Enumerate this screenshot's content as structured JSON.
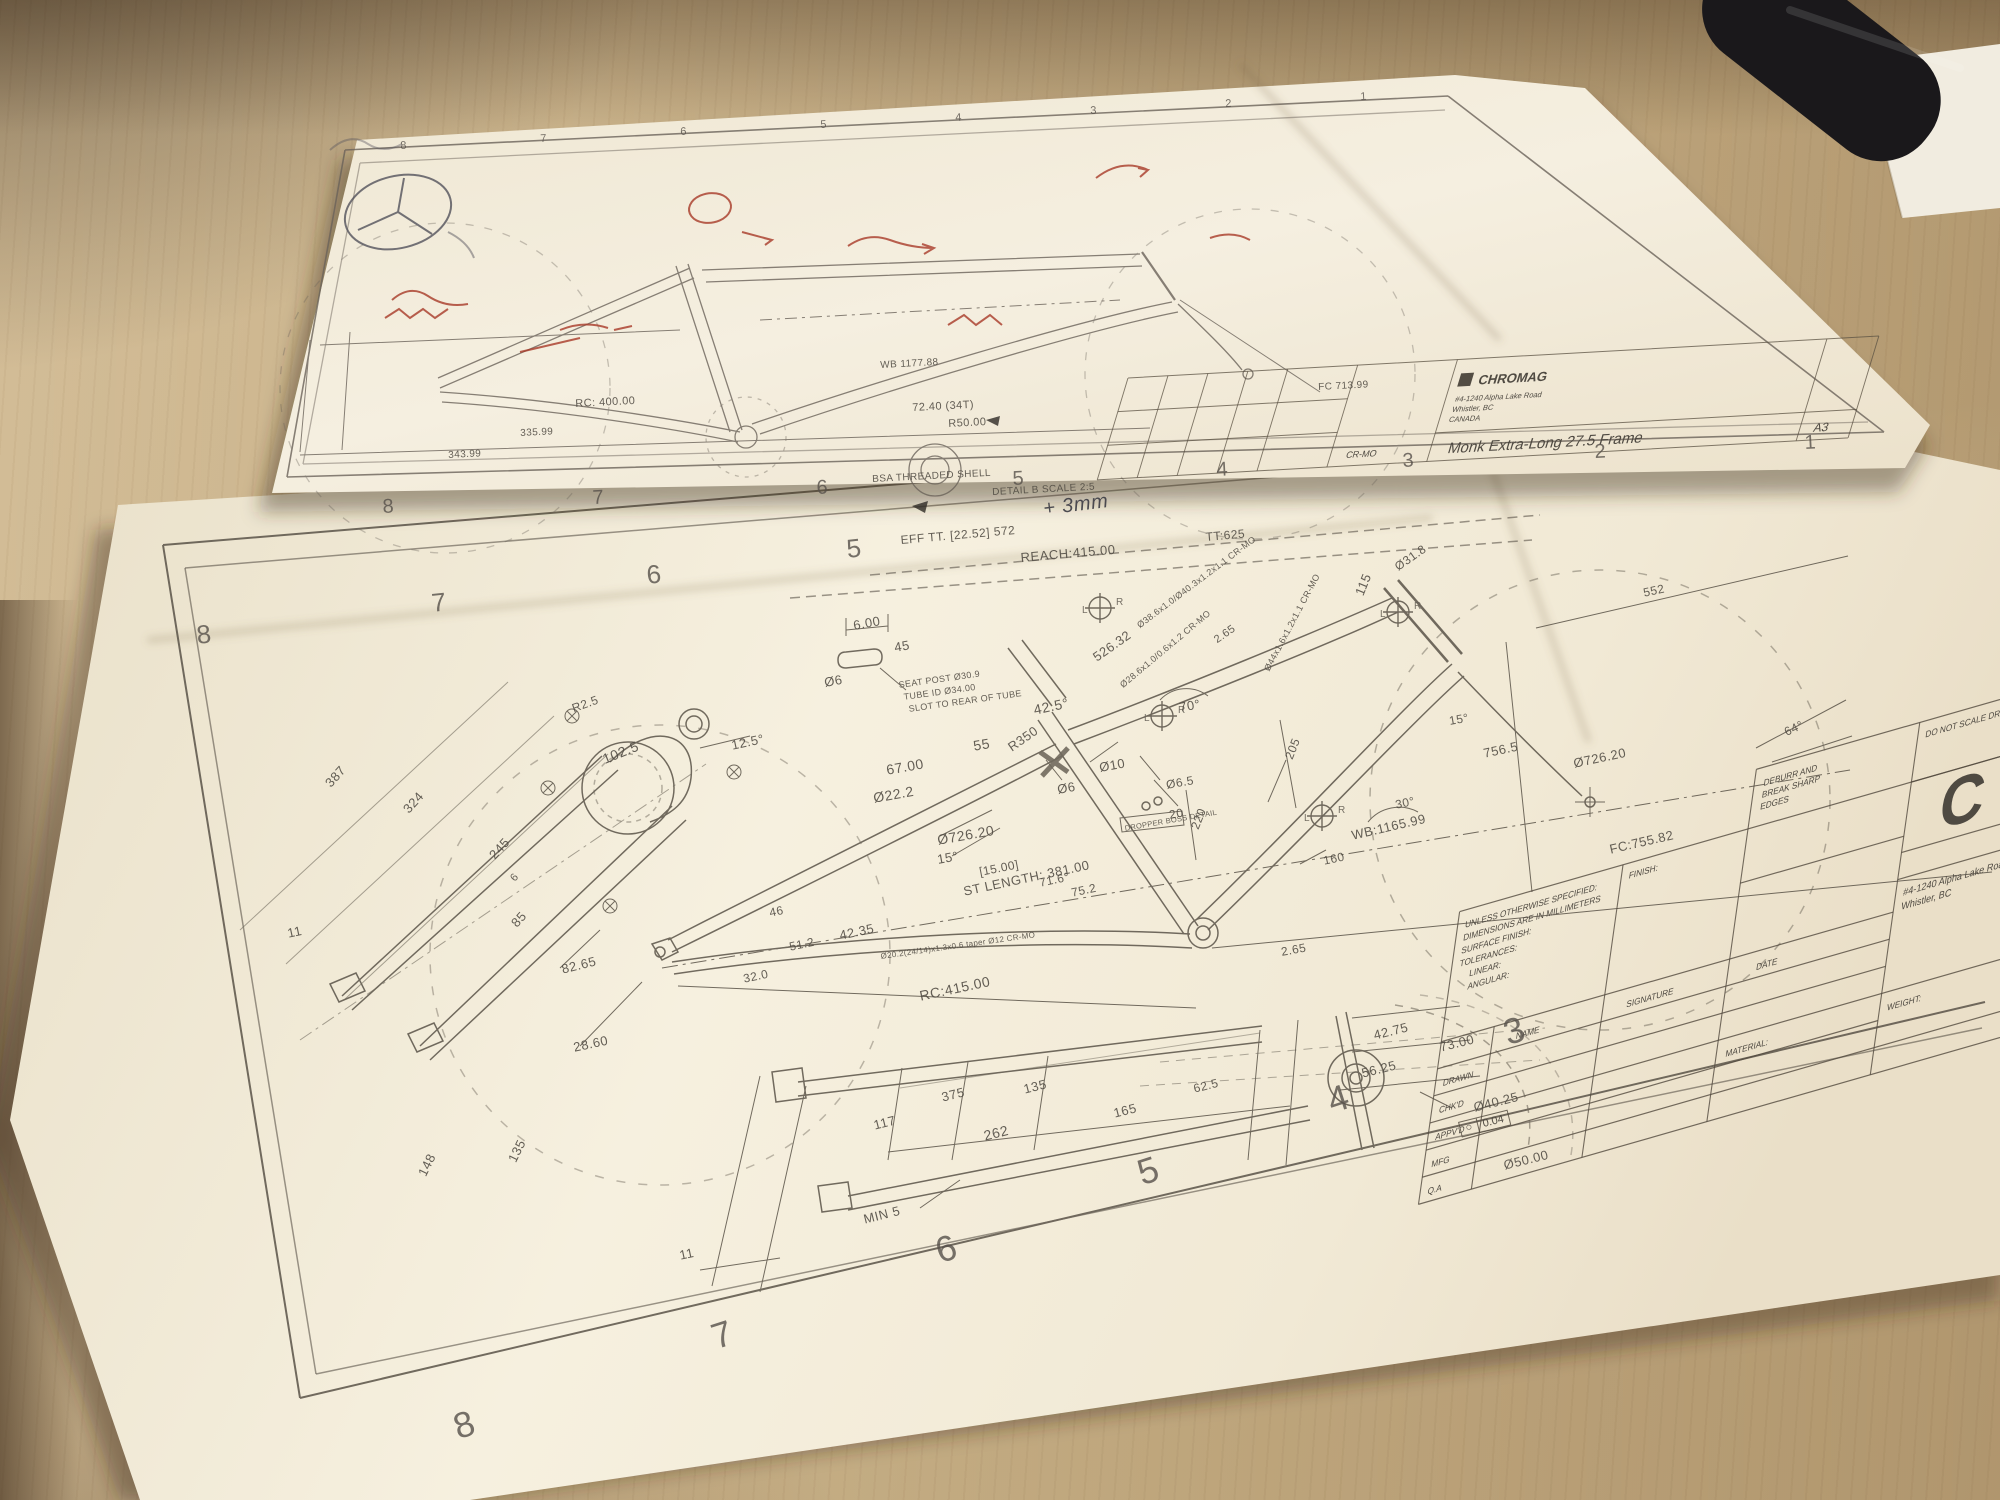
{
  "colors": {
    "wood": "#cdb88f",
    "paper": "#f3ecda",
    "ink": "#4f4a42",
    "red_annotation": "#a83a28"
  },
  "top_sheet": {
    "zones_bottom": [
      "8",
      "7",
      "6",
      "5",
      "4",
      "3",
      "2",
      "1"
    ],
    "zones_top": [
      "8",
      "7",
      "6",
      "5",
      "4",
      "3",
      "2",
      "1"
    ],
    "labels": {
      "rc400": "RC: 400.00",
      "d335": "335.99",
      "d343": "343.99",
      "d7240": "72.40 (34T)",
      "r50": "R50.00",
      "wb": "WB 1177.88",
      "fc": "FC 713.99",
      "bsa": "BSA THREADED SHELL",
      "detail": "DETAIL B SCALE 2:5",
      "note": "+ 3mm"
    },
    "title_block": {
      "company": "CHROMAG",
      "addr1": "#4-1240 Alpha Lake Road",
      "addr2": "Whistler, BC",
      "addr3": "CANADA",
      "title": "Monk Extra-Long 27.5 Frame",
      "size": "A3",
      "material": "CR-MO"
    }
  },
  "bottom_sheet": {
    "zones_top": [
      "8",
      "7",
      "6",
      "5"
    ],
    "zones_bottom": [
      "8",
      "7",
      "6",
      "5",
      "4",
      "3"
    ],
    "symbols": {
      "lr_l": "L",
      "lr_r": "R",
      "tol_sym": "○"
    },
    "labels": {
      "eff_tt": "EFF TT. [22.52] 572",
      "reach": "REACH:415.00",
      "tt": "TT:625",
      "slot600": "6.00",
      "slot45": "45",
      "slotdia": "Ø6",
      "sp1": "SEAT POST Ø30.9",
      "sp2": "TUBE ID Ø34.00",
      "sp3": "SLOT TO REAR OF TUBE",
      "deg425": "42.5°",
      "d55": "55",
      "r350": "R350",
      "dia318": "Ø31.8",
      "d115": "115",
      "deg70": "70°",
      "d52632": "526.32",
      "spec_dt": "Ø38.6x1.0/Ø40.3x1.2x1.1 CR-MO",
      "spec_ss": "Ø28.6x1.0/0.6x1.2 CR-MO",
      "spec_st": "Ø44x1.6x1.2x1.1 CR-MO",
      "d67": "67.00",
      "dia222": "Ø22.2",
      "dia10": "Ø10",
      "dia6": "Ø6",
      "dia65": "Ø6.5",
      "d20": "20",
      "dropper": "DROPPER BOSS DETAIL",
      "d220": "220",
      "d205": "205",
      "d160": "160",
      "d265a": "2.65",
      "d265b": "2.65",
      "dia726l": "Ø726.20",
      "deg15l": "15°",
      "br15": "[15.00]",
      "stlen": "ST LENGTH: 381.00",
      "deg716": "71.6°",
      "d752": "75.2",
      "d7565": "756.5",
      "dia726r": "Ø726.20",
      "deg64": "64°",
      "d552": "552",
      "deg15r": "15°",
      "deg30": "30°",
      "wb": "WB:1165.99",
      "fc": "FC:755.82",
      "rc": "RC:415.00",
      "d4235": "42.35",
      "d46": "46",
      "d512": "51.2",
      "d320": "32.0",
      "spec_cs": "Ø20.2(24/14)x1.3x0.6 taper Ø12 CR-MO",
      "d387": "387",
      "d324": "324",
      "d245": "245",
      "d6": "6",
      "d85": "85",
      "d8265": "82.65",
      "d2860": "28.60",
      "d1025": "102.5",
      "r25": "R2.5",
      "deg125": "12.5°",
      "d11a": "11",
      "d117": "117",
      "d375": "375",
      "d135a": "135",
      "d262": "262",
      "d165": "165",
      "min5": "MIN 5",
      "d11b": "11",
      "d148": "148",
      "d135b": "135",
      "d4275": "42.75",
      "d7300": "73.00",
      "d5625": "56.25",
      "d625": "62.5",
      "dia4025": "Ø40.25",
      "tol004": "0.04",
      "dia5000": "Ø50.00"
    },
    "title_block": {
      "spec1": "UNLESS OTHERWISE SPECIFIED:",
      "spec2": "DIMENSIONS ARE IN MILLIMETERS",
      "spec3": "SURFACE FINISH:",
      "spec4": "TOLERANCES:",
      "spec5": "LINEAR:",
      "spec6": "ANGULAR:",
      "finish": "FINISH:",
      "deburr1": "DEBURR AND",
      "deburr2": "BREAK SHARP",
      "deburr3": "EDGES",
      "do_not": "DO NOT SCALE DRAWING",
      "name": "NAME",
      "signature": "SIGNATURE",
      "date": "DATE",
      "drawn": "DRAWN",
      "chkd": "CHK'D",
      "appvd": "APPV'D",
      "mfg": "MFG",
      "qa": "Q.A",
      "material": "MATERIAL:",
      "weight": "WEIGHT:",
      "logo": "C",
      "addr1": "#4-1240 Alpha Lake Road",
      "addr2": "Whistler, BC"
    }
  }
}
